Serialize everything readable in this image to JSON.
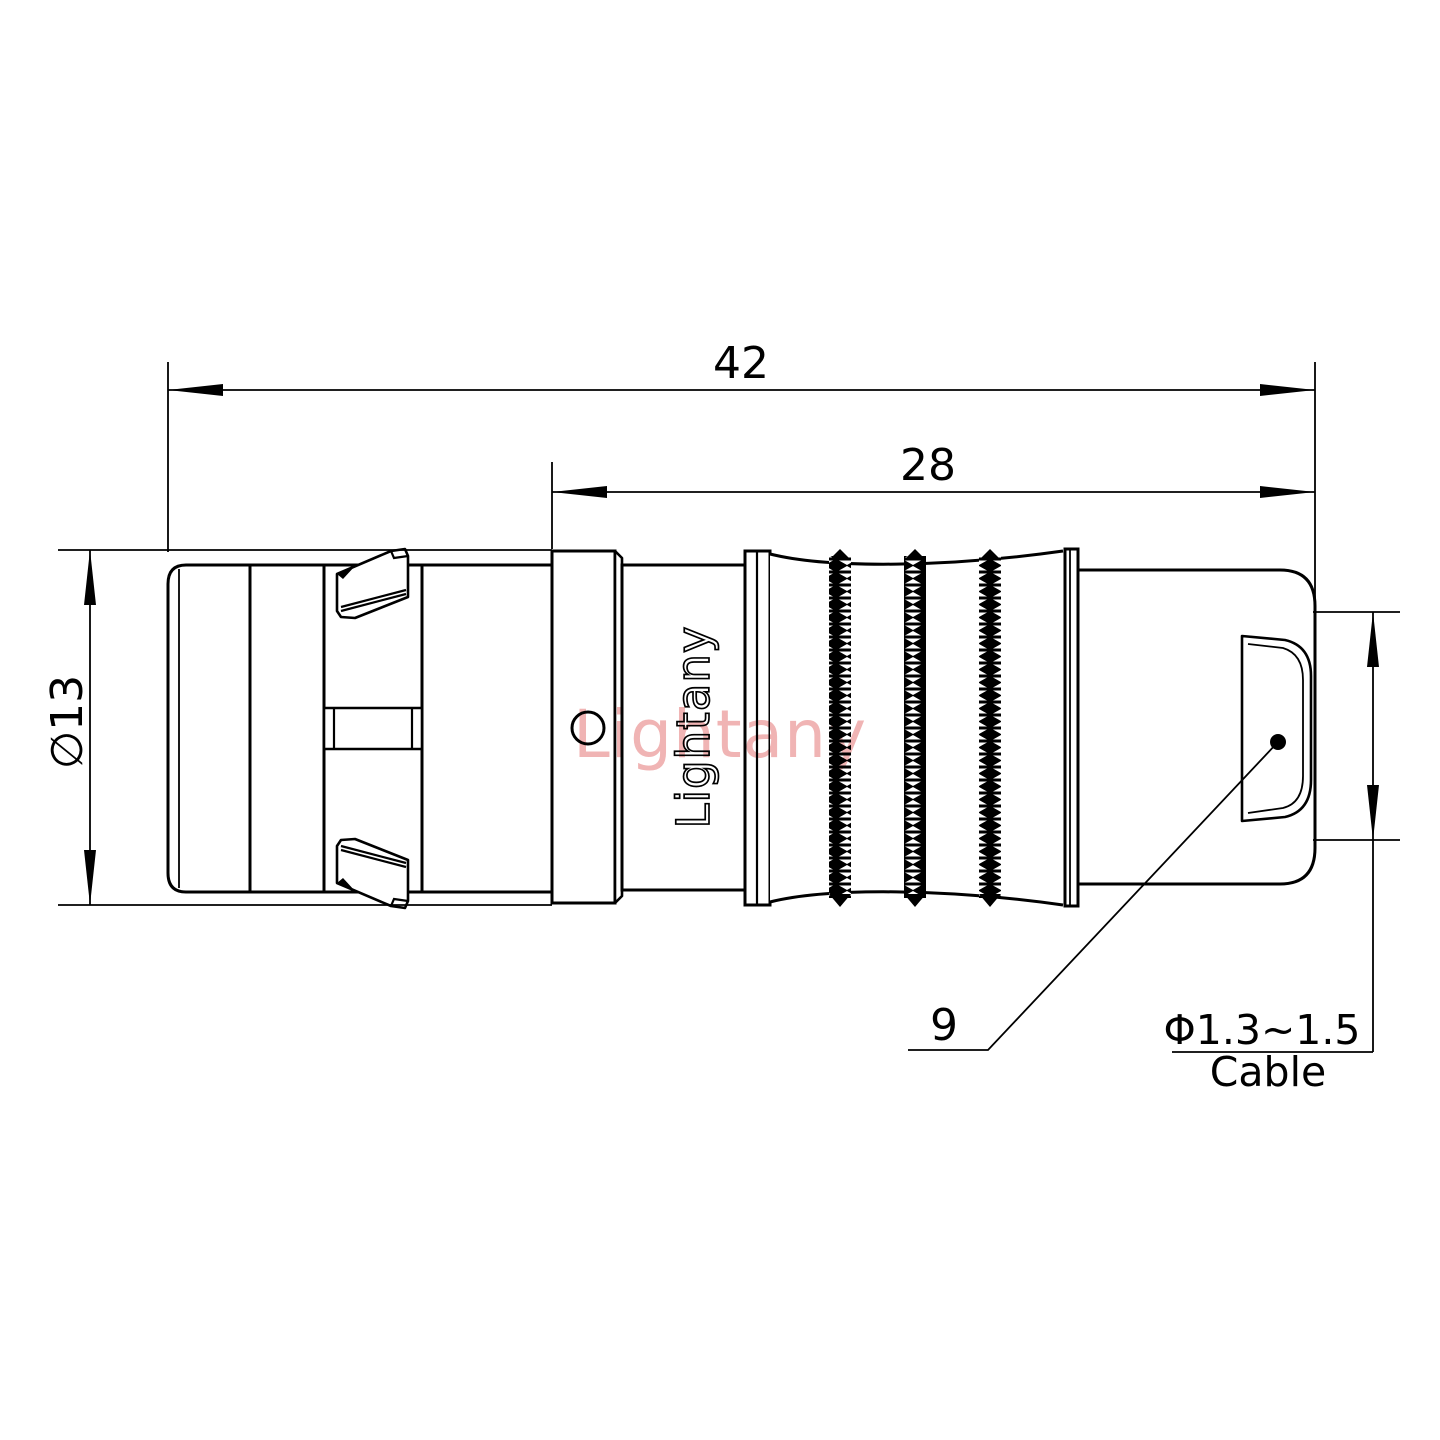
{
  "drawing": {
    "type": "connector-technical-drawing",
    "colors": {
      "line": "#000000",
      "watermark": "#f0b4b4"
    },
    "dimensions": {
      "overall_length": "42",
      "rear_length": "28",
      "body_diameter": "∅13",
      "nut_size": "9",
      "cable_diameter": "Φ1.3~1.5",
      "cable_word": "Cable"
    },
    "brand": {
      "engraving": "Lightany",
      "watermark": "Lightany"
    }
  }
}
